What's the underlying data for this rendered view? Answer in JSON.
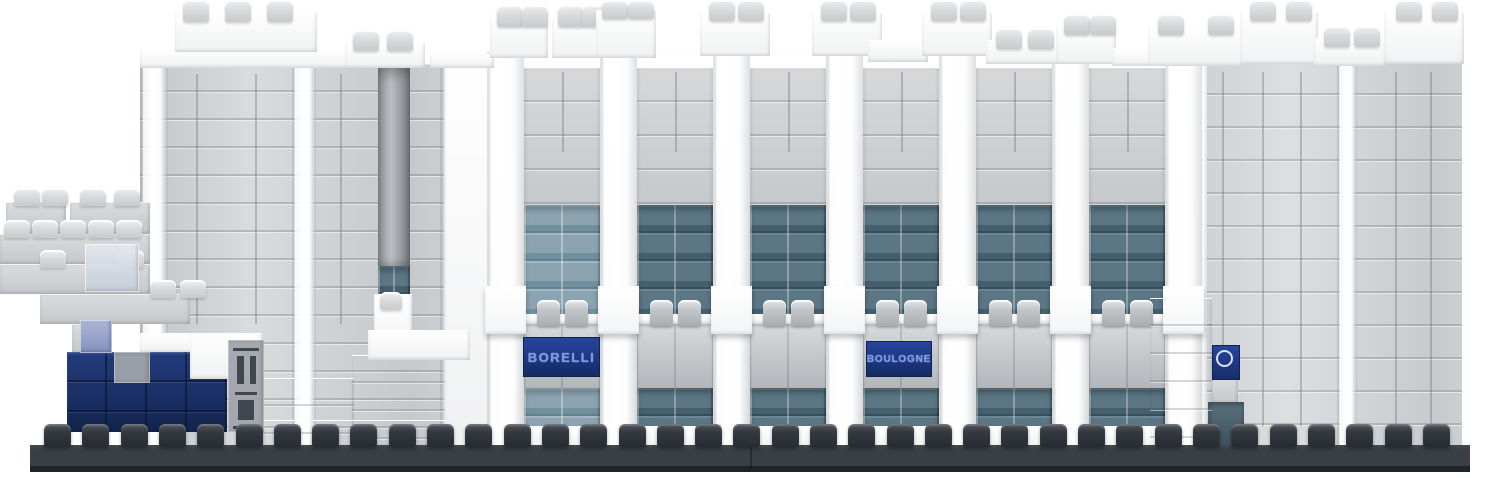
{
  "meta": {
    "description": "Micro-brick (LEGO-style) model of a stadium facade in white and light grey bricks with teal window strips, navy stand signs, on a dark grey studded baseplate"
  },
  "signs": {
    "borelli": "BORELLI",
    "boulogne": "BOULOGNE",
    "crest_icon": "club-crest-ring"
  },
  "palette": {
    "white_brick": "#fbfcfc",
    "gray_brick": "#ced1d4",
    "slate_hi": "#6d8695",
    "slate": "#5b7685",
    "slate_lo": "#455f6c",
    "slate_edge": "#374f5b",
    "light_hi": "#a4b8c4",
    "light": "#8ca3b1",
    "light_lo": "#71909f",
    "light_edge": "#5f8191",
    "navy_sign_hi": "#26459c",
    "navy_sign": "#1c3781",
    "navy_sign_lo": "#142a61",
    "sign_letter": "#7e9ae1",
    "navy_hi": "#223b7c",
    "navy": "#192f63",
    "navy_lo": "#12234b",
    "base_plate": "#3a3e45",
    "base_edge": "#202329"
  },
  "scene": {
    "canvas": {
      "w": 1500,
      "h": 478
    },
    "base": {
      "x": 30,
      "w": 1440,
      "y": 445,
      "h": 27,
      "seam_x": 750,
      "stud": {
        "start": 44,
        "count": 37,
        "spacing": 38.3,
        "w": 27,
        "h": 23,
        "top_y": 424
      }
    },
    "facade": {
      "wall": {
        "x": 445,
        "y": 52,
        "w": 762,
        "h": 396
      },
      "first_bay": 524,
      "period": 113,
      "bay_w": 76,
      "pillar_w": 37,
      "pillars": 7,
      "bands": {
        "gray_top": 68,
        "gray_bot": 205,
        "win1_top": 205,
        "win1_bot": 316,
        "ledge_y": 314,
        "ledge_h": 10,
        "stud_y": 300,
        "stud_h": 26,
        "stud_dx": [
          13,
          41
        ],
        "stud_w": 23,
        "tile_top": 324,
        "tile_bot": 388,
        "win2_top": 388,
        "win2_bot": 426,
        "bottom": 448
      },
      "jut": {
        "y": 286,
        "h": 48
      },
      "bays": [
        {
          "window": "light",
          "sign": "borelli"
        },
        {
          "window": "slate"
        },
        {
          "window": "slate"
        },
        {
          "window": "slate",
          "sign": "boulogne"
        },
        {
          "window": "slate"
        },
        {
          "window": "slate"
        }
      ]
    },
    "left_tower": {
      "face": {
        "x": 140,
        "y": 64,
        "w": 347,
        "h": 384
      },
      "white_stripes": [
        {
          "x": 140,
          "w": 28
        },
        {
          "x": 292,
          "w": 24
        },
        {
          "x": 440,
          "w": 47
        }
      ],
      "vseams": [
        196,
        255,
        340
      ],
      "slot": {
        "x": 378,
        "y": 64,
        "w": 32,
        "h": 202
      },
      "slot_window": {
        "x": 378,
        "y": 266,
        "w": 32,
        "h": 32
      },
      "slot_white": {
        "x": 374,
        "y": 294,
        "w": 38,
        "h": 66
      },
      "slot_stud": {
        "x": 380,
        "y": 292,
        "w": 22,
        "h": 18
      },
      "slabs": [
        {
          "x": 140,
          "y": 333,
          "w": 122,
          "h": 20
        },
        {
          "x": 368,
          "y": 330,
          "w": 102,
          "h": 30
        }
      ],
      "steps": [
        {
          "x": 262,
          "y": 378,
          "w": 92,
          "h": 70
        },
        {
          "x": 352,
          "y": 355,
          "w": 118,
          "h": 93
        },
        {
          "x": 262,
          "y": 420,
          "w": 208,
          "h": 28
        }
      ]
    },
    "right_wing": {
      "face": {
        "x": 1180,
        "y": 62,
        "w": 282,
        "h": 384
      },
      "white_stripes": [
        {
          "x": 1337,
          "w": 20
        }
      ],
      "vseams": [
        1222,
        1262,
        1300,
        1395,
        1430
      ],
      "under_crest_tile": {
        "x": 1212,
        "y": 378,
        "w": 26,
        "h": 26
      },
      "door": {
        "x": 1208,
        "y": 402,
        "w": 36,
        "h": 44
      }
    },
    "roof_blocks": [
      {
        "x": 140,
        "y": 50,
        "w": 212,
        "h": 18
      },
      {
        "x": 175,
        "y": 12,
        "w": 142,
        "h": 40,
        "studs": [
          8,
          50,
          92
        ],
        "sy": 0,
        "sh": 16
      },
      {
        "x": 345,
        "y": 42,
        "w": 80,
        "h": 26,
        "studs": [
          8,
          42
        ],
        "sy": 30,
        "sh": 15
      },
      {
        "x": 430,
        "y": 54,
        "w": 64,
        "h": 14
      },
      {
        "x": 490,
        "y": 18,
        "w": 58,
        "h": 40,
        "studs": [
          7,
          32
        ],
        "sy": 5,
        "sh": 16
      },
      {
        "x": 552,
        "y": 18,
        "w": 56,
        "h": 40,
        "studs": [
          6,
          30
        ],
        "sy": 5,
        "sh": 16
      },
      {
        "x": 596,
        "y": 10,
        "w": 60,
        "h": 48,
        "studs": [
          6,
          32
        ],
        "sy": 0,
        "sh": 13
      },
      {
        "x": 700,
        "y": 12,
        "w": 70,
        "h": 44,
        "studs": [
          9,
          38
        ],
        "sy": 0,
        "sh": 15
      },
      {
        "x": 812,
        "y": 12,
        "w": 70,
        "h": 44,
        "studs": [
          9,
          38
        ],
        "sy": 0,
        "sh": 15
      },
      {
        "x": 868,
        "y": 40,
        "w": 60,
        "h": 22
      },
      {
        "x": 922,
        "y": 12,
        "w": 70,
        "h": 44,
        "studs": [
          9,
          38
        ],
        "sy": 0,
        "sh": 15
      },
      {
        "x": 986,
        "y": 40,
        "w": 74,
        "h": 24,
        "studs": [
          10,
          42
        ],
        "sy": 28,
        "sh": 15
      },
      {
        "x": 1056,
        "y": 26,
        "w": 60,
        "h": 38,
        "studs": [
          8,
          34
        ],
        "sy": 14,
        "sh": 15
      },
      {
        "x": 1112,
        "y": 48,
        "w": 76,
        "h": 18
      },
      {
        "x": 1148,
        "y": 26,
        "w": 96,
        "h": 40,
        "studs": [
          10,
          60
        ],
        "sy": 14,
        "sh": 15
      },
      {
        "x": 1240,
        "y": 12,
        "w": 78,
        "h": 52,
        "studs": [
          10,
          46
        ],
        "sy": 0,
        "sh": 15
      },
      {
        "x": 1314,
        "y": 38,
        "w": 72,
        "h": 28,
        "studs": [
          10,
          40
        ],
        "sy": 26,
        "sh": 15
      },
      {
        "x": 1384,
        "y": 12,
        "w": 80,
        "h": 52,
        "studs": [
          12,
          48
        ],
        "sy": 0,
        "sh": 15
      },
      {
        "x": 1150,
        "y": 298,
        "w": 62,
        "h": 150,
        "seams": true
      },
      {
        "x": 368,
        "y": 330,
        "w": 102,
        "h": 30
      }
    ],
    "outbuilding": {
      "stud_w": 26,
      "stud_h": 18,
      "rows": [
        {
          "x": 6,
          "y": 202,
          "w": 60,
          "h": 32,
          "studs": [
            8,
            36
          ],
          "sy": 188
        },
        {
          "x": 70,
          "y": 202,
          "w": 80,
          "h": 32,
          "studs": [
            10,
            44
          ],
          "sy": 188
        },
        {
          "x": 0,
          "y": 234,
          "w": 150,
          "h": 30,
          "studs": [
            4,
            32,
            60,
            88,
            116
          ],
          "sy": 220
        },
        {
          "x": 0,
          "y": 264,
          "w": 150,
          "h": 30,
          "studs": [
            40,
            118
          ],
          "sy": 250
        },
        {
          "x": 40,
          "y": 294,
          "w": 150,
          "h": 30,
          "studs": [
            110,
            140
          ],
          "sy": 280
        },
        {
          "x": 72,
          "y": 324,
          "w": 40,
          "h": 30
        }
      ],
      "trans_assembly": {
        "x": 85,
        "y": 244,
        "w": 54,
        "h": 48
      }
    },
    "navy_section": {
      "main": {
        "x": 67,
        "y": 352,
        "w": 160,
        "h": 80
      },
      "slab": {
        "x": 190,
        "y": 333,
        "w": 72,
        "h": 46
      },
      "trans_blue": {
        "x": 80,
        "y": 320,
        "w": 32,
        "h": 33
      },
      "machine_print": {
        "x": 114,
        "y": 352,
        "w": 36,
        "h": 31
      },
      "turnstile": {
        "x": 228,
        "y": 340,
        "w": 36,
        "h": 92,
        "ink": [
          {
            "x": 233,
            "y": 348,
            "w": 26,
            "h": 3
          },
          {
            "x": 237,
            "y": 356,
            "w": 7,
            "h": 28
          },
          {
            "x": 250,
            "y": 356,
            "w": 6,
            "h": 28
          },
          {
            "x": 235,
            "y": 392,
            "w": 22,
            "h": 3
          },
          {
            "x": 238,
            "y": 400,
            "w": 16,
            "h": 20
          },
          {
            "x": 233,
            "y": 426,
            "w": 26,
            "h": 3
          }
        ]
      }
    }
  }
}
